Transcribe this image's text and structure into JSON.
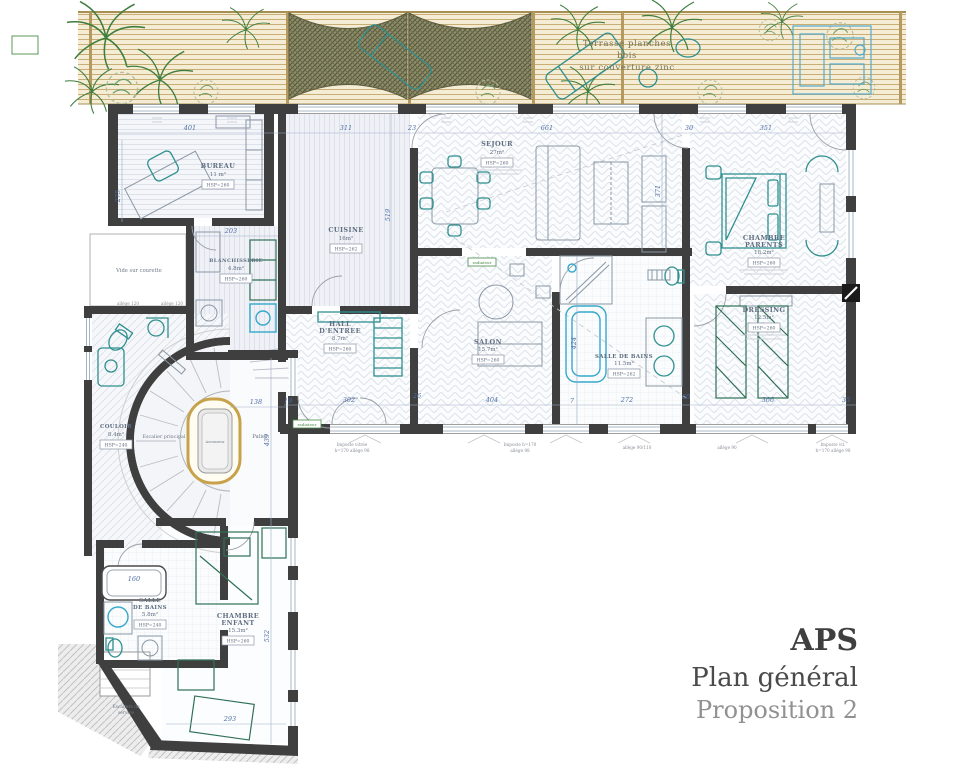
{
  "title_block": {
    "title": "APS",
    "subtitle": "Plan général",
    "proposition": "Proposition 2"
  },
  "terrace": {
    "line1": "Terrasse planches",
    "line2": "bois",
    "line3": "sur couverture zinc"
  },
  "labels": {
    "vide_courette": "Vide sur courette",
    "escalier_principal": "Escalier principal",
    "ascenseur": "Ascenseur",
    "palier": "Palier",
    "escaliers_service_1": "Escaliers de",
    "escaliers_service_2": "service",
    "radiateur": "radiateur"
  },
  "rooms": {
    "bureau": {
      "name": "BUREAU",
      "area": "11 m²",
      "hsp": "HSP=260"
    },
    "blanchisserie": {
      "name": "BLANCHISSERIE",
      "area": "4.8m²",
      "hsp": "HSP=260"
    },
    "cuisine": {
      "name": "CUISINE",
      "area": "16m²",
      "hsp": "HSP=262"
    },
    "sejour": {
      "name": "SEJOUR",
      "area": "27m²",
      "hsp": "HSP=260"
    },
    "chambre_parents": {
      "name_line1": "CHAMBRE",
      "name_line2": "PARENTS",
      "area": "18.2m²",
      "hsp": "HSP=260"
    },
    "dressing": {
      "name": "DRESSING",
      "area": "12.5m²",
      "hsp": "HSP=260"
    },
    "salle_de_bains": {
      "name": "SALLE DE BAINS",
      "area": "11.5m²",
      "hsp": "HSP=262"
    },
    "salon": {
      "name": "SALON",
      "area": "15.7m²",
      "hsp": "HSP=260"
    },
    "hall": {
      "name_line1": "HALL",
      "name_line2": "D'ENTREE",
      "area": "8.7m²",
      "hsp": "HSP=260"
    },
    "couloir": {
      "name": "COULOIR",
      "area": "8.4m²",
      "hsp": "HSP=240"
    },
    "sdb_enfant": {
      "name_line1": "SALLE",
      "name_line2": "DE BAINS",
      "area": "5.8m²",
      "hsp": "HSP=240"
    },
    "chambre_enfant": {
      "name_line1": "CHAMBRE",
      "name_line2": "ENFANT",
      "area": "15.3m²",
      "hsp": "HSP=260"
    }
  },
  "dimensions": [
    {
      "label": "401",
      "x": 190,
      "y": 130,
      "rot": 0
    },
    {
      "label": "311",
      "x": 346,
      "y": 130,
      "rot": 0
    },
    {
      "label": "23",
      "x": 412,
      "y": 130,
      "rot": 0
    },
    {
      "label": "661",
      "x": 547,
      "y": 130,
      "rot": 0
    },
    {
      "label": "30",
      "x": 689,
      "y": 130,
      "rot": 0
    },
    {
      "label": "351",
      "x": 766,
      "y": 130,
      "rot": 0
    },
    {
      "label": "275",
      "x": 120,
      "y": 196,
      "rot": -90
    },
    {
      "label": "203",
      "x": 231,
      "y": 233,
      "rot": 0
    },
    {
      "label": "519",
      "x": 390,
      "y": 215,
      "rot": -90
    },
    {
      "label": "371",
      "x": 660,
      "y": 191,
      "rot": -90
    },
    {
      "label": "424",
      "x": 576,
      "y": 343,
      "rot": -90
    },
    {
      "label": "138",
      "x": 256,
      "y": 404,
      "rot": 0
    },
    {
      "label": "439",
      "x": 269,
      "y": 440,
      "rot": -90
    },
    {
      "label": "532",
      "x": 269,
      "y": 636,
      "rot": -90
    },
    {
      "label": "293",
      "x": 230,
      "y": 721,
      "rot": 0
    },
    {
      "label": "19",
      "x": 288,
      "y": 403,
      "rot": 0
    },
    {
      "label": "302",
      "x": 349,
      "y": 402,
      "rot": 0
    },
    {
      "label": "26",
      "x": 417,
      "y": 398,
      "rot": 0
    },
    {
      "label": "404",
      "x": 492,
      "y": 402,
      "rot": 0
    },
    {
      "label": "7",
      "x": 572,
      "y": 403,
      "rot": 0
    },
    {
      "label": "272",
      "x": 627,
      "y": 402,
      "rot": 0
    },
    {
      "label": "60",
      "x": 686,
      "y": 399,
      "rot": 0
    },
    {
      "label": "366",
      "x": 768,
      "y": 402,
      "rot": 0
    },
    {
      "label": "35",
      "x": 846,
      "y": 402,
      "rot": 0
    },
    {
      "label": "160",
      "x": 134,
      "y": 581,
      "rot": 0
    }
  ],
  "window_notes": [
    {
      "label": "allège 120",
      "x": 128,
      "y": 305
    },
    {
      "label": "allège 120",
      "x": 172,
      "y": 305
    },
    {
      "label": "Imposte vitrée",
      "x": 352,
      "y": 446
    },
    {
      "label": "h=170  allège 98",
      "x": 352,
      "y": 452
    },
    {
      "label": "Imposte h=170",
      "x": 520,
      "y": 446
    },
    {
      "label": "allège 98",
      "x": 520,
      "y": 452
    },
    {
      "label": "allège 90/110",
      "x": 637,
      "y": 449
    },
    {
      "label": "allège 90",
      "x": 727,
      "y": 449
    },
    {
      "label": "Imposte vit.",
      "x": 833,
      "y": 446
    },
    {
      "label": "h=170  allège 98",
      "x": 833,
      "y": 452
    }
  ],
  "colors": {
    "wall": "#3f3f3f",
    "dimension_text": "#4e6fa3",
    "furniture_teal": "#2f8f8f",
    "furniture_green": "#2f7055",
    "fixture_blue": "#35a8cc",
    "stair_gold": "#c8a24b",
    "terrace_wood": "#c8ad74",
    "plant_green": "#3e7d3e",
    "title_dark": "#3f3f3f",
    "title_gray": "#919191"
  }
}
